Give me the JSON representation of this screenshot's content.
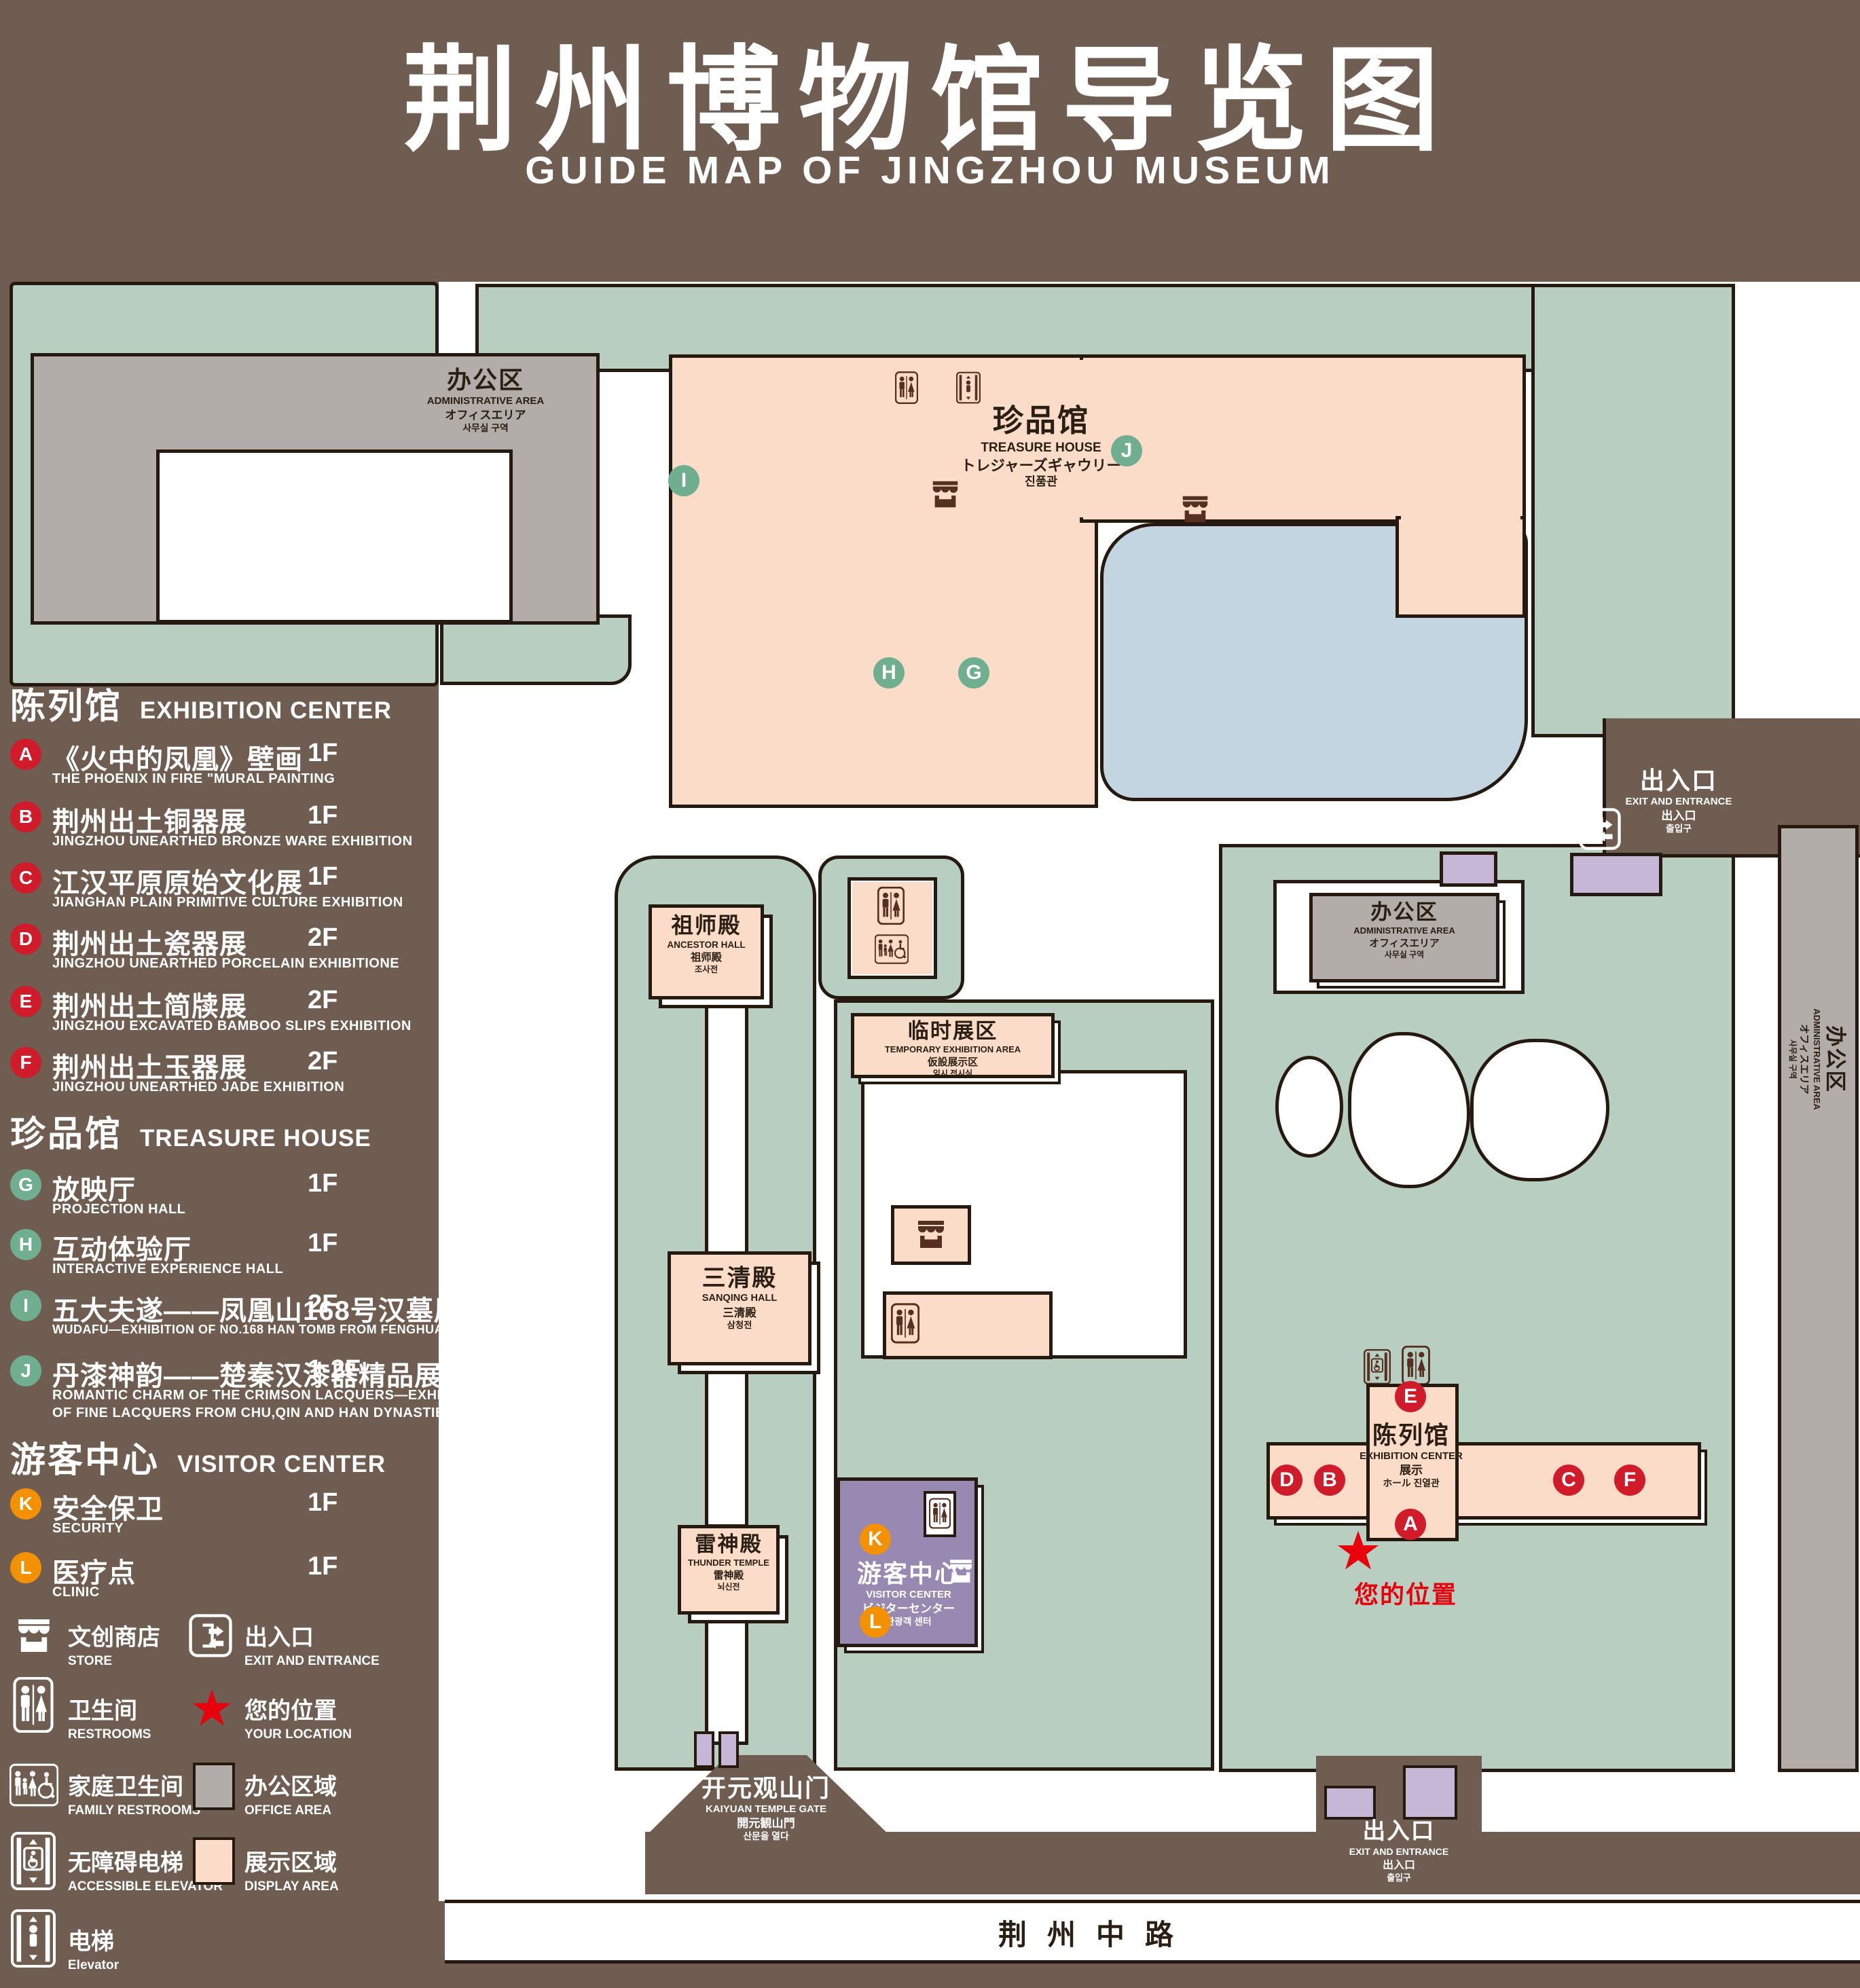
{
  "page": {
    "title_zh": "荆州博物馆导览图",
    "title_en": "GUIDE MAP OF JINGZHOU MUSEUM"
  },
  "legend": {
    "sections": [
      {
        "title_zh": "陈列馆",
        "title_en": "EXHIBITION CENTER",
        "items": [
          {
            "letter": "A",
            "name_zh": "《火中的凤凰》壁画",
            "name_en": "THE PHOENIX IN FIRE \"MURAL PAINTING",
            "floor": "1F"
          },
          {
            "letter": "B",
            "name_zh": "荆州出土铜器展",
            "name_en": "JINGZHOU UNEARTHED BRONZE WARE EXHIBITION",
            "floor": "1F"
          },
          {
            "letter": "C",
            "name_zh": "江汉平原原始文化展",
            "name_en": "JIANGHAN PLAIN PRIMITIVE CULTURE EXHIBITION",
            "floor": "1F"
          },
          {
            "letter": "D",
            "name_zh": "荆州出土瓷器展",
            "name_en": "JINGZHOU UNEARTHED PORCELAIN EXHIBITIONE",
            "floor": "2F"
          },
          {
            "letter": "E",
            "name_zh": "荆州出土简牍展",
            "name_en": "JINGZHOU EXCAVATED BAMBOO SLIPS EXHIBITION",
            "floor": "2F"
          },
          {
            "letter": "F",
            "name_zh": "荆州出土玉器展",
            "name_en": "JINGZHOU UNEARTHED JADE EXHIBITION",
            "floor": "2F"
          }
        ]
      },
      {
        "title_zh": "珍品馆",
        "title_en": "TREASURE HOUSE",
        "items": [
          {
            "letter": "G",
            "name_zh": "放映厅",
            "name_en": "PROJECTION HALL",
            "floor": "1F"
          },
          {
            "letter": "H",
            "name_zh": "互动体验厅",
            "name_en": "INTERACTIVE EXPERIENCE HALL",
            "floor": "1F"
          },
          {
            "letter": "I",
            "name_zh": "五大夫遂——凤凰山168号汉墓展",
            "name_en": "WUDAFU—EXHIBITION OF NO.168 HAN TOMB FROM FENGHUANGSHAN",
            "floor": "2F"
          },
          {
            "letter": "J",
            "name_zh": "丹漆神韵——楚秦汉漆器精品展",
            "name_en": "ROMANTIC CHARM OF THE CRIMSON LACQUERS—EXHIBITIONS",
            "name_en2": "OF FINE LACQUERS FROM CHU,QIN AND HAN DYNASTIES",
            "floor": "1-2F"
          }
        ]
      },
      {
        "title_zh": "游客中心",
        "title_en": "VISITOR CENTER",
        "items": [
          {
            "letter": "K",
            "name_zh": "安全保卫",
            "name_en": "SECURITY",
            "floor": "1F"
          },
          {
            "letter": "L",
            "name_zh": "医疗点",
            "name_en": "CLINIC",
            "floor": "1F"
          }
        ]
      }
    ],
    "symbols": [
      {
        "icon": "store-icon",
        "zh": "文创商店",
        "en": "STORE"
      },
      {
        "icon": "exit-entrance-icon",
        "zh": "出入口",
        "en": "EXIT AND ENTRANCE"
      },
      {
        "icon": "restrooms-icon",
        "zh": "卫生间",
        "en": "RESTROOMS"
      },
      {
        "icon": "location-star-icon",
        "zh": "您的位置",
        "en": "YOUR LOCATION"
      },
      {
        "icon": "family-restrooms-icon",
        "zh": "家庭卫生间",
        "en": "FAMILY RESTROOMS"
      },
      {
        "icon": "office-area-swatch",
        "zh": "办公区域",
        "en": "OFFICE AREA"
      },
      {
        "icon": "accessible-elevator-icon",
        "zh": "无障碍电梯",
        "en": "ACCESSIBLE ELEVATOR"
      },
      {
        "icon": "display-area-swatch",
        "zh": "展示区域",
        "en": "DISPLAY AREA"
      },
      {
        "icon": "elevator-icon",
        "zh": "电梯",
        "en": "Elevator"
      }
    ]
  },
  "map": {
    "labels": {
      "admin": {
        "zh": "办公区",
        "en": "ADMINISTRATIVE AREA",
        "ja": "オフィスエリア",
        "ko": "사무실 구역"
      },
      "treasure_house": {
        "zh": "珍品馆",
        "en": "TREASURE HOUSE",
        "ja": "トレジャーズギャウリー",
        "ko": "진품관"
      },
      "ancestor_hall": {
        "zh": "祖师殿",
        "en": "ANCESTOR HALL",
        "ja": "祖师殿",
        "ko": "조사전"
      },
      "sanqing_hall": {
        "zh": "三清殿",
        "en": "SANQING HALL",
        "ja": "三清殿",
        "ko": "삼청전"
      },
      "thunder_temple": {
        "zh": "雷神殿",
        "en": "THUNDER TEMPLE",
        "ja": "雷神殿",
        "ko": "뇌신전"
      },
      "temporary": {
        "zh": "临时展区",
        "en": "TEMPORARY EXHIBITION AREA",
        "ja": "仮設展示区",
        "ko": "임시 전시실"
      },
      "visitor_center": {
        "zh": "游客中心",
        "en": "VISITOR CENTER",
        "ja": "ビジターセンター",
        "ko": "관광객 센터"
      },
      "exhibition_center": {
        "zh": "陈列馆",
        "en": "EXHIBITION CENTER",
        "ja": "展示",
        "ko": "ホール 진열관"
      },
      "exit": {
        "zh": "出入口",
        "en": "EXIT AND ENTRANCE",
        "ja": "出入口",
        "ko": "출입구"
      },
      "gate": {
        "zh": "开元观山门",
        "en": "KAIYUAN TEMPLE GATE",
        "ja": "開元観山門",
        "ko": "산문을 열다"
      },
      "road": "荆州中路",
      "your_location": "您的位置"
    },
    "badges": {
      "A": "A",
      "B": "B",
      "C": "C",
      "D": "D",
      "E": "E",
      "F": "F",
      "G": "G",
      "H": "H",
      "I": "I",
      "J": "J",
      "K": "K",
      "L": "L"
    }
  },
  "colors": {
    "background": "#6E5D50",
    "lawn": "#B7CEC0",
    "display_area": "#FADCC9",
    "office_area": "#B2ADA8",
    "visitor_center": "#9789B2",
    "gate_purple": "#C6B7D6",
    "pond": "#C3D5E1",
    "outline": "#261910",
    "badge_red": "#D01B2A",
    "badge_green": "#6FAE8F",
    "badge_orange": "#F39100",
    "location_red": "#E8000D"
  }
}
